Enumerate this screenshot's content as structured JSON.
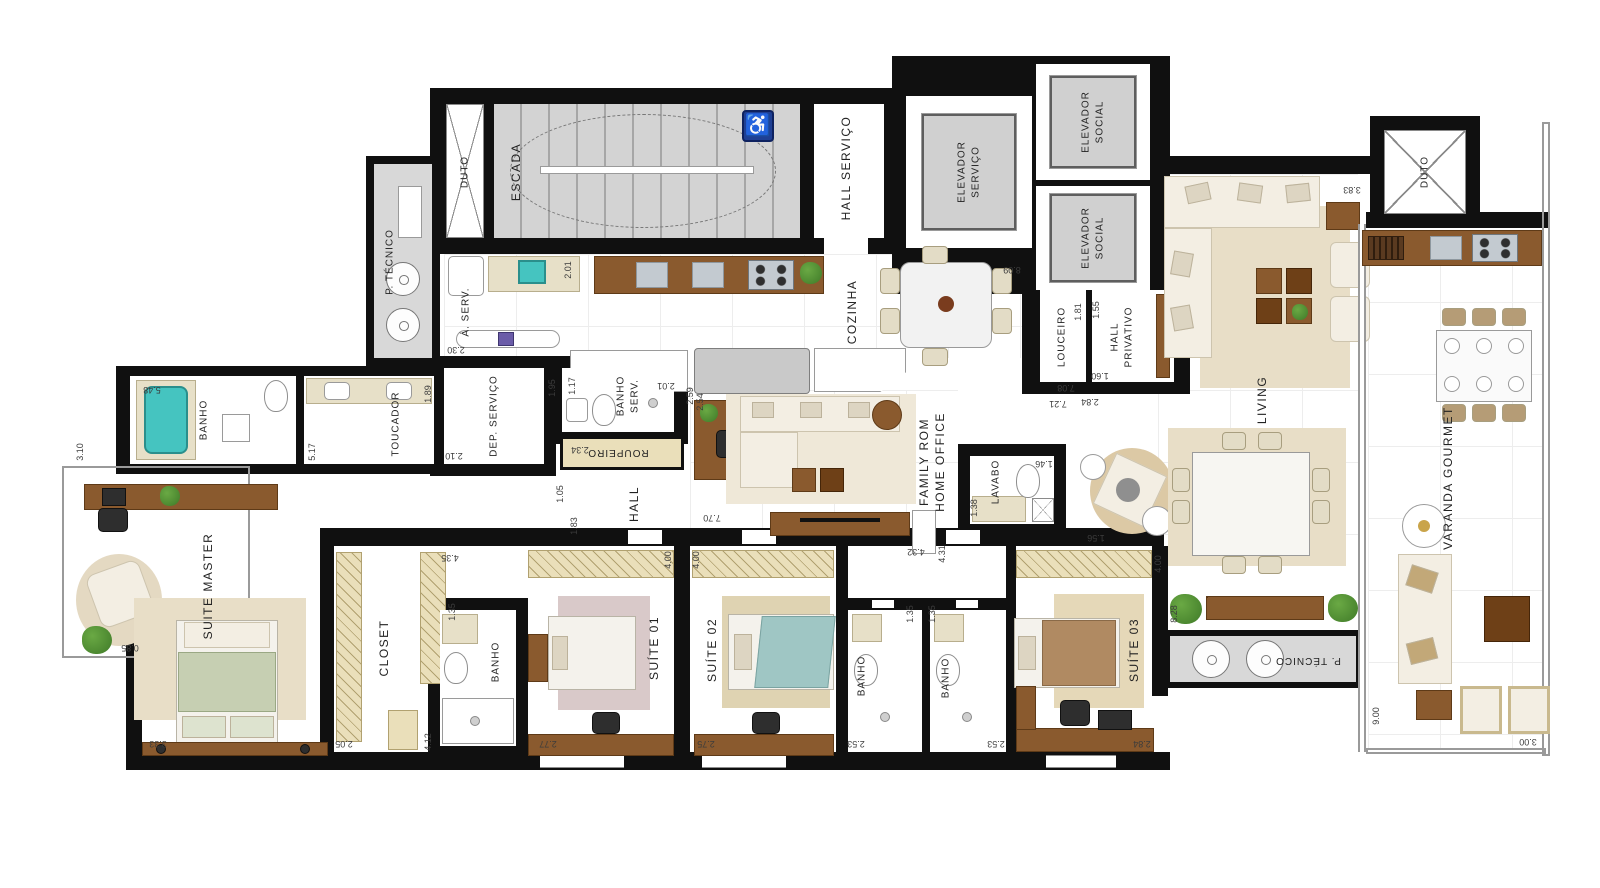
{
  "rooms": {
    "escada": "ESCADA",
    "duto_top_left": "DUTO",
    "p_tecnico_top": "P. TÉCNICO",
    "hall_servico": "HALL SERVIÇO",
    "elevador_servico": "ELEVADOR\nSERVIÇO",
    "elevador_social_1": "ELEVADOR\nSOCIAL",
    "elevador_social_2": "ELEVADOR\nSOCIAL",
    "a_serv": "Á. SERV.",
    "cozinha": "COZINHA",
    "louceiro": "LOUCEIRO",
    "hall_privativo": "HALL\nPRIVATIVO",
    "living": "LIVING",
    "duto_top_right": "DUTO",
    "varanda_gourmet": "VARANDA GOURMET",
    "dep_servico": "DEP. SERVIÇO",
    "banho_serv": "BANHO\nSERV.",
    "roupeiro": "ROUPEIRO",
    "hall": "HALL",
    "banho_master": "BANHO",
    "toucador": "TOUCADOR",
    "suite_master": "SUITE MASTER",
    "closet": "CLOSET",
    "banho_suite01": "BANHO",
    "suite_01": "SUÍTE 01",
    "suite_02": "SUÍTE 02",
    "banho_suite02": "BANHO",
    "banho_suite03": "BANHO",
    "suite_03": "SUÍTE 03",
    "family_room": "FAMILY ROM\nHOME OFFICE",
    "lavabo": "LAVABO",
    "p_tecnico_bottom": "P. TÉCNICO"
  },
  "dims": {
    "d230": "2.30",
    "d201a": "2.01",
    "d809": "8.09",
    "d254": "2.54",
    "d548": "5.48",
    "d189": "1.89",
    "d195": "1.95",
    "d210": "2.10",
    "d117": "1.17",
    "d201b": "2.01",
    "d234": "2.34",
    "d259": "2.59",
    "d105": "1.05",
    "d183": "1.83",
    "d310": "3.10",
    "d517": "5.17",
    "d085": "0.85",
    "d333": "3.33",
    "d205": "2.05",
    "d412": "4.12",
    "d135a": "1.35",
    "d435": "4.35",
    "d277": "2.77",
    "d400a": "4.00",
    "d400b": "4.00",
    "d275": "2.75",
    "d770": "7.70",
    "d432": "4.32",
    "d431": "4.31",
    "d146": "1.46",
    "d138": "1.38",
    "d156": "1.56",
    "d253a": "2.53",
    "d253b": "2.53",
    "d135b": "1.35",
    "d135c": "1.35",
    "d284a": "2.84",
    "d828": "8.28",
    "d400c": "4.00",
    "d181": "1.81",
    "d708": "7.08",
    "d721": "7.21",
    "d155": "1.55",
    "d160": "1.60",
    "d284b": "2.84",
    "d383": "3.83",
    "d900": "9.00",
    "d300": "3.00"
  },
  "icons": {
    "accessibility": "♿"
  },
  "colors": {
    "wall": "#101010",
    "gray_room": "#d8d8d8",
    "wood": "#8a5a2e",
    "beige": "#eadfba",
    "cream": "#f3eee3",
    "rug": "#e8dec7",
    "teal_tub": "#45c4c0",
    "plant": "#4f8f35",
    "accessibility_blue": "#1e3f94",
    "steel": "#c3cad0"
  }
}
